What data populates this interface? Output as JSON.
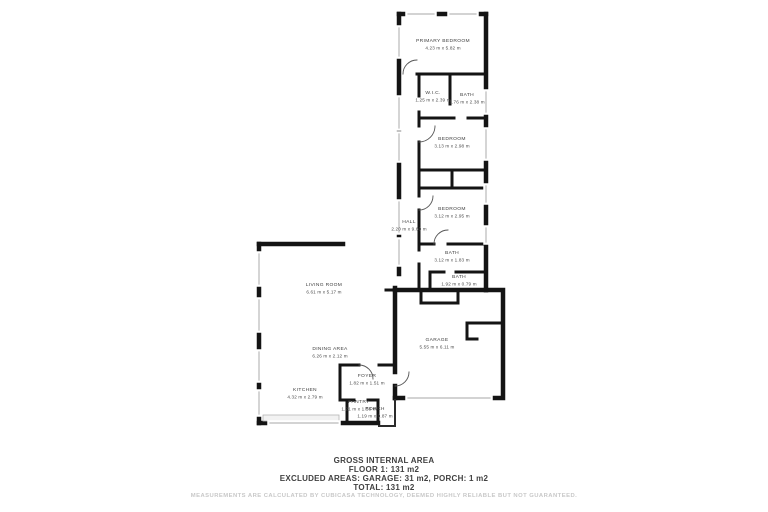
{
  "floorplan": {
    "rooms": [
      {
        "name": "PRIMARY BEDROOM",
        "dims": "4.23 m x 5.82 m"
      },
      {
        "name": "W.I.C.",
        "dims": "1.25 m x 2.39 m"
      },
      {
        "name": "BATH",
        "dims": "1.76 m x 2.38 m"
      },
      {
        "name": "BEDROOM",
        "dims": "3.13 m x 2.98 m"
      },
      {
        "name": "BEDROOM",
        "dims": "3.12 m x 2.95 m"
      },
      {
        "name": "HALL",
        "dims": "2.20 m x 9.60 m"
      },
      {
        "name": "BATH",
        "dims": "3.12 m x 1.83 m"
      },
      {
        "name": "BATH",
        "dims": "1.92 m x 0.79 m"
      },
      {
        "name": "LIVING ROOM",
        "dims": "6.61 m x 5.17 m"
      },
      {
        "name": "DINING AREA",
        "dims": "6.26 m x 2.12 m"
      },
      {
        "name": "FOYER",
        "dims": "1.82 m x 1.51 m"
      },
      {
        "name": "KITCHEN",
        "dims": "4.32 m x 2.79 m"
      },
      {
        "name": "PANTRY",
        "dims": "1.21 m x 1.58 m"
      },
      {
        "name": "PORCH",
        "dims": "1.19 m x 0.87 m"
      },
      {
        "name": "GARAGE",
        "dims": "5.55 m x 6.11 m"
      }
    ],
    "wall_color": "#141414",
    "window_color": "#b9b9b9"
  },
  "summary": {
    "title": "GROSS INTERNAL AREA",
    "floor": "FLOOR 1: 131 m2",
    "excluded": "EXCLUDED AREAS: GARAGE: 31 m2, PORCH: 1 m2",
    "total": "TOTAL: 131 m2"
  },
  "watermark": "MEASUREMENTS ARE CALCULATED BY CUBICASA TECHNOLOGY, DEEMED HIGHLY RELIABLE BUT NOT GUARANTEED."
}
